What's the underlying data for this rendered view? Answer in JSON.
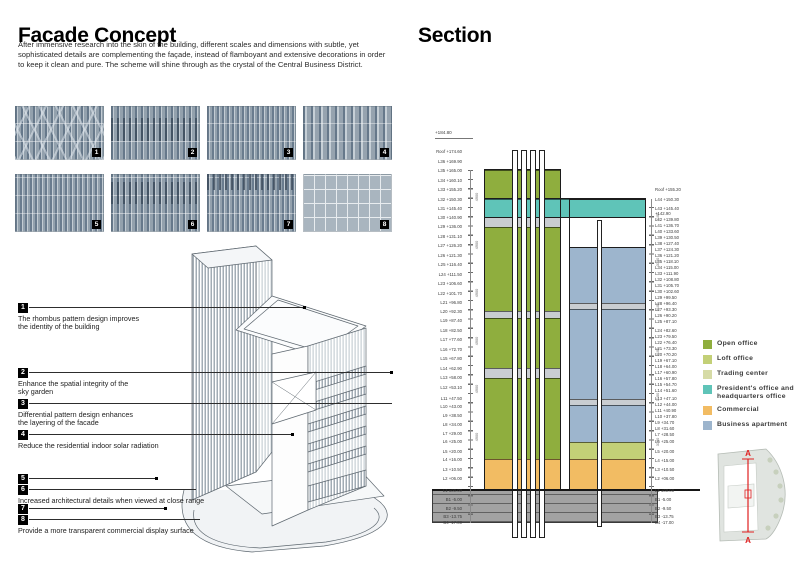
{
  "facade": {
    "title": "Facade Concept",
    "intro": "After immensive research into the skin of the building, different scales and dimensions with subtle, yet sophisticated details are complementing the façade, instead of flamboyant and extensive decorations in order to keep it clean and pure. The scheme will shine through as the crystal of the Central Business District.",
    "patterns": [
      {
        "num": "1",
        "name": "stripes with rhombus overlay"
      },
      {
        "num": "2",
        "name": "stripes with dark comb band"
      },
      {
        "num": "3",
        "name": "dense stripes"
      },
      {
        "num": "4",
        "name": "wide stripes"
      },
      {
        "num": "5",
        "name": "dense stripes"
      },
      {
        "num": "6",
        "name": "stripes with comb and joints"
      },
      {
        "num": "7",
        "name": "dense stripes with comb top"
      },
      {
        "num": "8",
        "name": "flat panel grid"
      }
    ],
    "annotations": [
      {
        "num": "1",
        "lines": [
          "The rhombus pattern design improves",
          "the identity of the building"
        ]
      },
      {
        "num": "2",
        "lines": [
          "Enhance the spatial integrity of the",
          "sky garden"
        ]
      },
      {
        "num": "3",
        "lines": [
          "Differential pattern design enhances",
          "the layering of the facade"
        ]
      },
      {
        "num": "4",
        "lines": [
          "Reduce the residential indoor solar radiation"
        ]
      },
      {
        "num": "5",
        "lines": []
      },
      {
        "num": "6",
        "lines": [
          "Increased architectural details when viewed at close range"
        ]
      },
      {
        "num": "7",
        "lines": []
      },
      {
        "num": "8",
        "lines": [
          "Provide a more transparent commercial display surface"
        ]
      }
    ]
  },
  "section": {
    "title": "Section",
    "top_elevation": "+184.80",
    "floor_height_left": "4900",
    "floor_height_right": "3100",
    "levels_left": [
      "Roof +174.60",
      "L36 +169.90",
      "L35 +165.00",
      "L34 +160.10",
      "L33 +155.20",
      "L32 +150.30",
      "L31 +145.40",
      "L30 +140.90",
      "L29 +136.00",
      "L28 +131.10",
      "L27 +126.20",
      "L26 +121.30",
      "L25 +116.40",
      "L24 +111.50",
      "L23 +106.60",
      "L22 +101.70",
      "L21 +96.80",
      "L20 +92.30",
      "L19 +87.40",
      "L18 +82.50",
      "L17 +77.60",
      "L16 +72.70",
      "L15 +67.80",
      "L14 +62.90",
      "L13 +58.00",
      "L12 +53.10",
      "L11 +47.50",
      "L10 +43.00",
      "L9 +38.50",
      "L8 +34.00",
      "L7 +29.00",
      "L6 +25.00",
      "L5 +20.00",
      "L4 +16.00",
      "L3 +10.50",
      "L2 +06.00",
      "L1 ±00.00",
      "B1 -5.00",
      "B2 -9.50",
      "B3 -13.75",
      "B4 -17.00"
    ],
    "levels_right": [
      "Roof +155.20",
      "L44 +150.30",
      "L43 +145.40",
      "+142.90",
      "L42 +139.80",
      "L41 +136.70",
      "L40 +133.60",
      "L39 +130.50",
      "L38 +127.40",
      "L37 +124.30",
      "L36 +121.20",
      "L35 +118.10",
      "L34 +115.00",
      "L33 +111.90",
      "L32 +108.80",
      "L31 +105.70",
      "L30 +102.60",
      "L29 +99.50",
      "L28 +96.40",
      "L27 +93.30",
      "L26 +90.20",
      "L25 +87.10",
      "L24 +82.60",
      "L23 +79.50",
      "L22 +76.40",
      "L21 +73.30",
      "L20 +70.20",
      "L19 +67.10",
      "L18 +64.00",
      "L17 +60.90",
      "L16 +57.80",
      "L15 +54.70",
      "L14 +51.60",
      "L13 +47.10",
      "L12 +44.00",
      "L11 +40.90",
      "L10 +37.80",
      "L9 +34.70",
      "L8 +31.60",
      "L7 +28.50",
      "L6 +25.00",
      "L5 +20.00",
      "L4 +15.00",
      "L3 +10.50",
      "L2 +06.00",
      "L1 ±00.00",
      "B1 -5.00",
      "B2 -9.50",
      "B3 -13.75",
      "B4 -17.00"
    ],
    "legend": [
      {
        "key": "open-office",
        "label": "Open office",
        "color": "#8fae3e"
      },
      {
        "key": "loft-office",
        "label": "Loft office",
        "color": "#c3d077"
      },
      {
        "key": "trading-center",
        "label": "Trading center",
        "color": "#d6dba6"
      },
      {
        "key": "president-office",
        "label": "President's office and headquarters office",
        "color": "#5fc4b8"
      },
      {
        "key": "commercial",
        "label": "Commercial",
        "color": "#f2bc63"
      },
      {
        "key": "business-apartment",
        "label": "Business apartment",
        "color": "#9db5cd"
      }
    ],
    "extra_colors": {
      "refuge": "#c9cdd1",
      "basement": "#a2a2a2"
    },
    "zones": {
      "bridge": {
        "use": "president-office",
        "from": 140.9,
        "to": 150.3
      },
      "left_tower": [
        {
          "use": "open-office",
          "from": 150.3,
          "to": 165.3
        },
        {
          "use": "refuge",
          "from": 136.0,
          "to": 140.9
        },
        {
          "use": "open-office",
          "from": 92.3,
          "to": 136.0
        },
        {
          "use": "refuge",
          "from": 89.0,
          "to": 92.3
        },
        {
          "use": "open-office",
          "from": 62.9,
          "to": 89.0
        },
        {
          "use": "refuge",
          "from": 58.0,
          "to": 62.9
        },
        {
          "use": "open-office",
          "from": 16.0,
          "to": 58.0
        },
        {
          "use": "commercial",
          "from": 0,
          "to": 16.0
        }
      ],
      "right_tower": [
        {
          "use": "business-apartment",
          "from": 96.4,
          "to": 125.5
        },
        {
          "use": "refuge",
          "from": 93.3,
          "to": 96.4
        },
        {
          "use": "business-apartment",
          "from": 47.1,
          "to": 93.3
        },
        {
          "use": "refuge",
          "from": 44.0,
          "to": 47.1
        },
        {
          "use": "business-apartment",
          "from": 25.0,
          "to": 44.0
        },
        {
          "use": "loft-office",
          "from": 16.0,
          "to": 25.0
        },
        {
          "use": "commercial",
          "from": 0,
          "to": 16.0
        }
      ],
      "basement": {
        "use": "basement",
        "from": -17.0,
        "to": 0
      }
    },
    "keyplan_marker": "A"
  }
}
